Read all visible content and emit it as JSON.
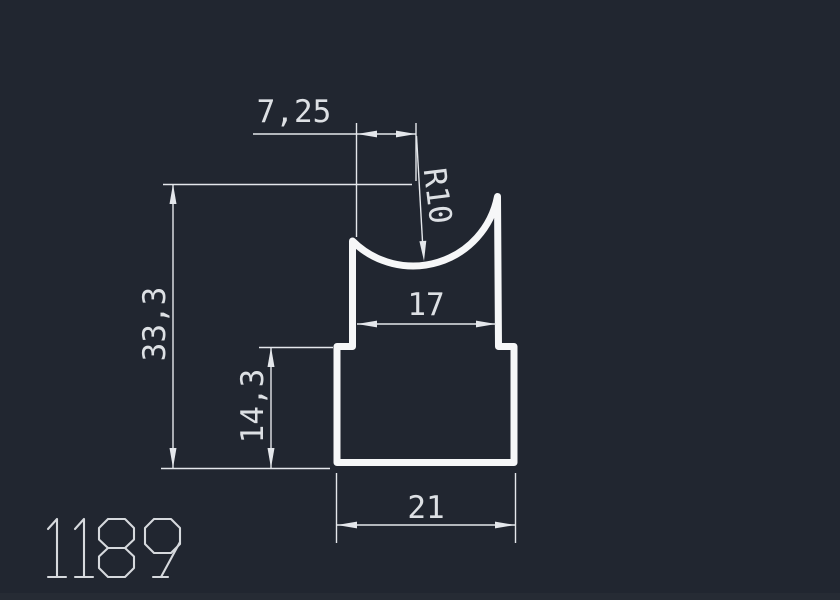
{
  "canvas": {
    "background": "#212630",
    "line_color": "#e4e7eb",
    "profile_color": "#f6f7f8",
    "text_color": "#dde0e4",
    "part_number_color": "#d6d9dd"
  },
  "drawing": {
    "part_number": "1189",
    "dimensions": {
      "top_offset": "7,25",
      "radius": "R10",
      "overall_height": "33,3",
      "inner_width": "17",
      "lower_height": "14,3",
      "bottom_width": "21"
    }
  }
}
